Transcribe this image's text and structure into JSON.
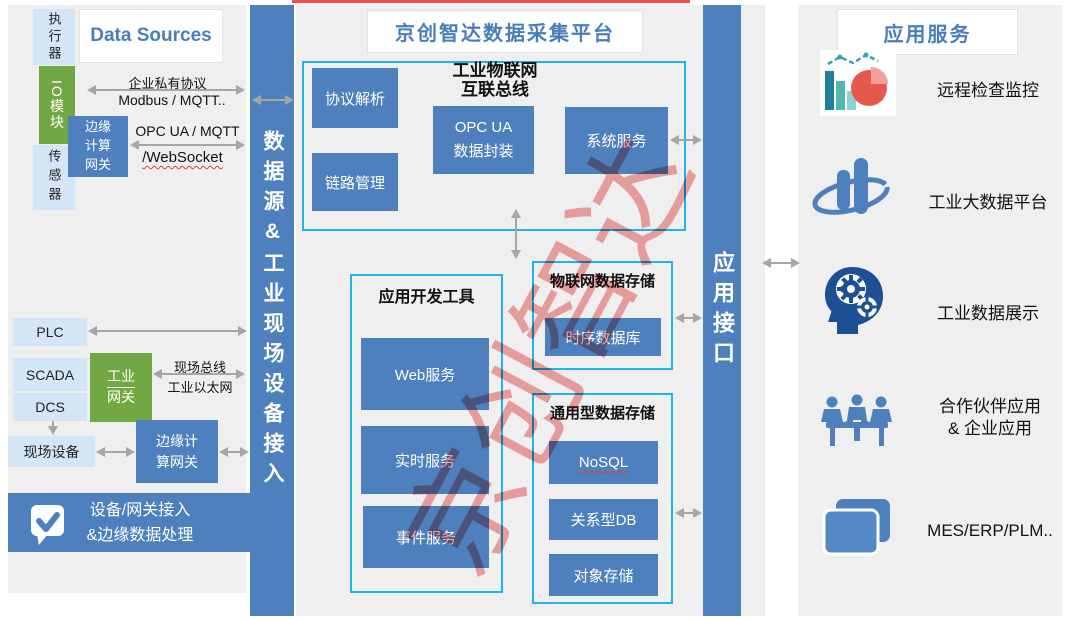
{
  "watermark_text": "京创智达",
  "left": {
    "panel_title": "Data Sources",
    "actuator": "执行器",
    "io_module": "IO模块",
    "sensor": "传感器",
    "edge_gateway": {
      "line1": "边缘",
      "line2": "计算",
      "line3": "网关"
    },
    "link1": {
      "above": "企业私有协议",
      "below": "Modbus  / MQTT.."
    },
    "link2": {
      "above": "OPC UA  / MQTT",
      "below": "/WebSocket"
    },
    "plc": "PLC",
    "scada": "SCADA",
    "dcs": "DCS",
    "industrial_gateway": {
      "line1": "工业",
      "line2": "网关"
    },
    "fieldbus": {
      "above": "现场总线",
      "below": "工业以太网"
    },
    "field_device": "现场设备",
    "edge_gateway2": {
      "line1": "边缘计",
      "line2": "算网关"
    },
    "banner": {
      "line1": "设备/网关接入",
      "line2": "&边缘数据处理"
    }
  },
  "bar_left": {
    "label": "数据源&工业现场设备接入"
  },
  "center": {
    "platform_title": "京创智达数据采集平台",
    "iot_bus": {
      "title1": "工业物联网",
      "title2": "互联总线",
      "protocol_parse": "协议解析",
      "link_mgmt": "链路管理",
      "opcua1": "OPC UA",
      "opcua2": "数据封装",
      "system_service": "系统服务"
    },
    "dev_tools": {
      "title": "应用开发工具",
      "items": [
        "Web服务",
        "实时服务",
        "事件服务"
      ]
    },
    "iot_storage": {
      "title": "物联网数据存储",
      "tsdb": "时序数据库"
    },
    "general_storage": {
      "title": "通用型数据存储",
      "items": [
        "NoSQL",
        "关系型DB",
        "对象存储"
      ]
    }
  },
  "bar_right": {
    "label": "应用接口"
  },
  "right": {
    "panel_title": "应用服务",
    "items": [
      {
        "icon": "monitor-chart-icon",
        "label": "远程检查监控"
      },
      {
        "icon": "big-data-icon",
        "label": "工业大数据平台"
      },
      {
        "icon": "head-gears-icon",
        "label": "工业数据展示"
      },
      {
        "icon": "partners-icon",
        "label": "合作伙伴应用",
        "label2": "& 企业应用"
      },
      {
        "icon": "enterprise-apps-icon",
        "label": "MES/ERP/PLM.."
      }
    ]
  },
  "colors": {
    "primary_blue": "#4d80bd",
    "light_blue": "#d4e6f5",
    "green": "#72a844",
    "cyan_border": "#1fb5e9",
    "panel_gray": "#efeff0",
    "arrow_gray": "#a6a6a6",
    "accent_red": "#fb4a4a",
    "title_blue": "#4a7ebb",
    "watermark_red": "#ee5b5b"
  }
}
